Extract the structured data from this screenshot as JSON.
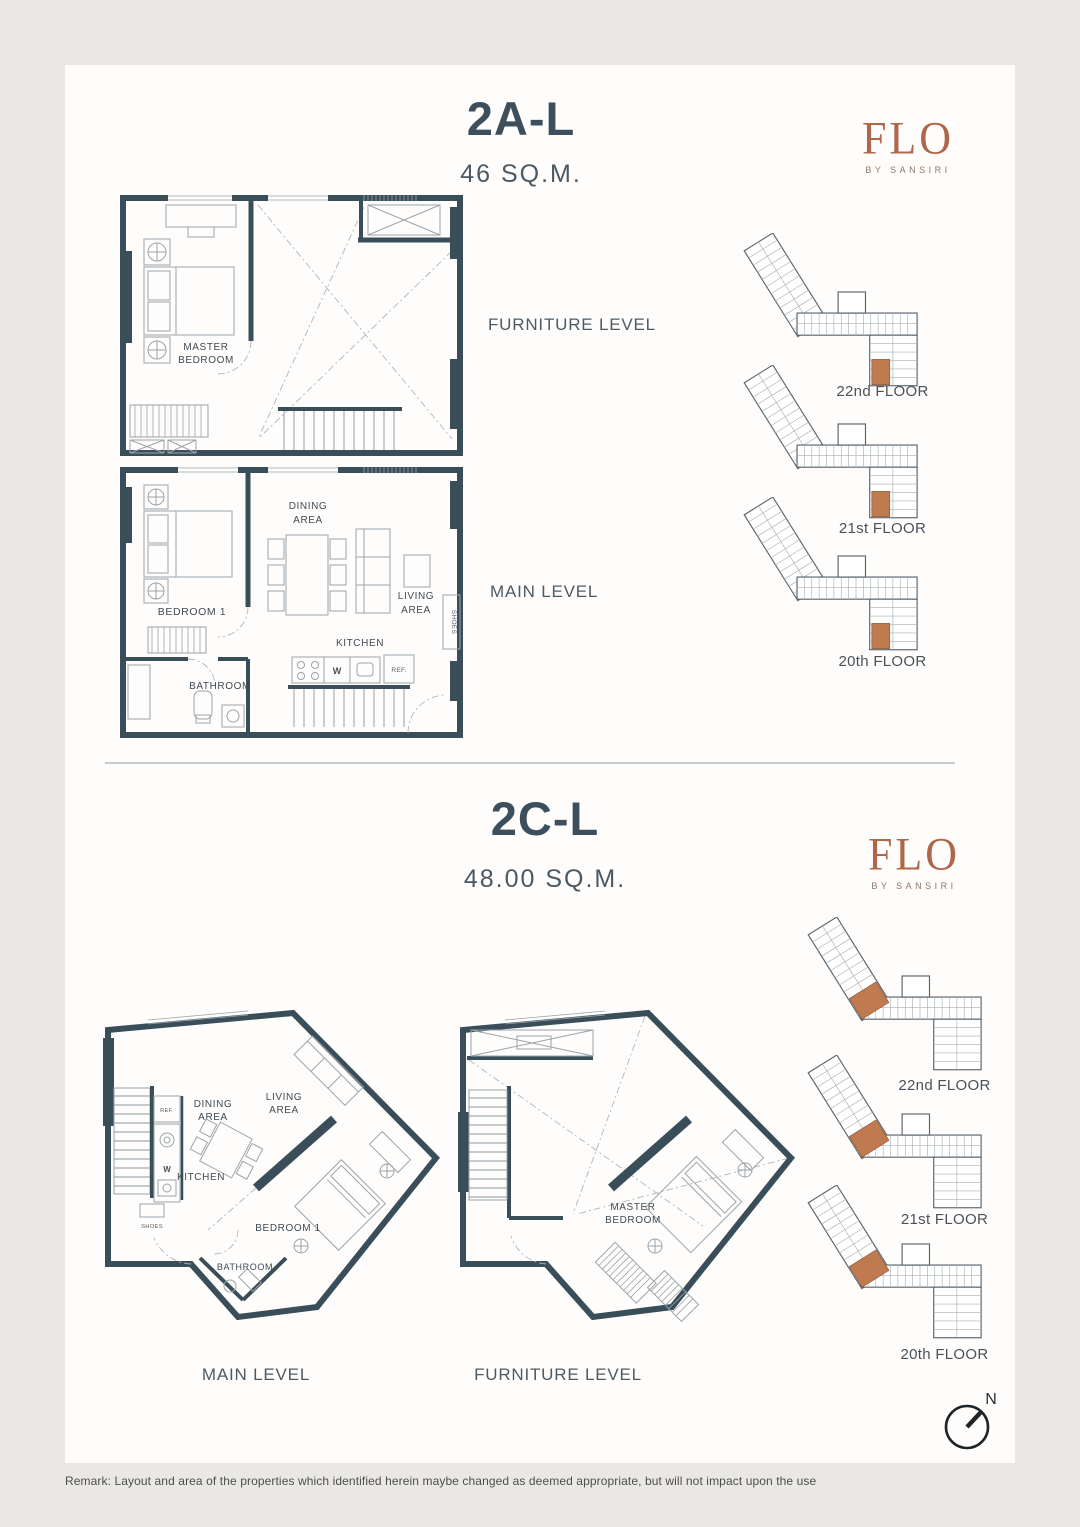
{
  "brand": {
    "name": "FLO",
    "tagline": "BY SANSIRI"
  },
  "compass_label": "N",
  "remark": "Remark: Layout and area of the properties which identified herein maybe changed as deemed appropriate, but will not impact upon the use",
  "colors": {
    "wall": "#3a4e5a",
    "brand_accent": "#ad6749",
    "unit_highlight": "#bf7a50",
    "title_text": "#3d4f5c",
    "page_background": "#e9e8e5",
    "card_background": "#fffdfb"
  },
  "unit_2a": {
    "name": "2A-L",
    "area": "46 SQ.M.",
    "levels": {
      "furniture": "FURNITURE LEVEL",
      "main": "MAIN LEVEL"
    },
    "floors": [
      "22nd FLOOR",
      "21st FLOOR",
      "20th FLOOR"
    ],
    "furniture_plan": {
      "master_line1": "MASTER",
      "master_line2": "BEDROOM"
    },
    "main_plan": {
      "bedroom": "BEDROOM 1",
      "dining_line1": "DINING",
      "dining_line2": "AREA",
      "living_line1": "LIVING",
      "living_line2": "AREA",
      "kitchen": "KITCHEN",
      "bathroom": "BATHROOM",
      "washer": "W",
      "fridge": "REF.",
      "shoes": "SHOES"
    }
  },
  "unit_2c": {
    "name": "2C-L",
    "area": "48.00 SQ.M.",
    "levels": {
      "main": "MAIN LEVEL",
      "furniture": "FURNITURE LEVEL"
    },
    "floors": [
      "22nd FLOOR",
      "21st FLOOR",
      "20th FLOOR"
    ],
    "main_plan": {
      "bedroom": "BEDROOM 1",
      "dining_line1": "DINING",
      "dining_line2": "AREA",
      "living_line1": "LIVING",
      "living_line2": "AREA",
      "kitchen": "KITCHEN",
      "bathroom": "BATHROOM",
      "washer": "W",
      "fridge": "REF.",
      "shoes": "SHOES"
    },
    "furniture_plan": {
      "master_line1": "MASTER",
      "master_line2": "BEDROOM"
    }
  }
}
